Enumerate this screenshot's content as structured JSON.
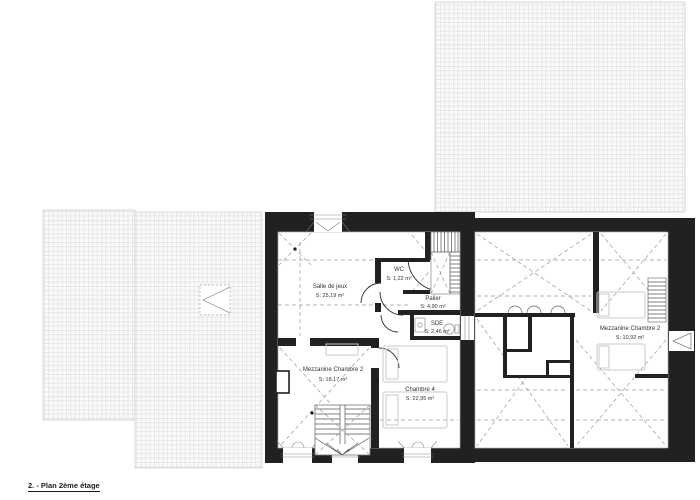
{
  "drawing": {
    "title": "2. - Plan 2ème étage"
  },
  "rooms": {
    "salle_de_jeux": {
      "name": "Salle de jeux",
      "area": "S: 25,19 m²"
    },
    "wc": {
      "name": "WC",
      "area": "S: 1,22 m²"
    },
    "palier": {
      "name": "Palier",
      "area": "S: 4,90 m²"
    },
    "sde": {
      "name": "SDE",
      "area": "S: 2,46 m²"
    },
    "mezzanine_chambre2": {
      "name": "Mezzanine Chambre 2",
      "area": "S: 18,17 m²"
    },
    "chambre4": {
      "name": "Chambre 4",
      "area": "S: 22,95 m²"
    },
    "mezzanine_chambre2_b": {
      "name": "Mezzanine Chambre 2",
      "area": "S: 10,92 m²"
    }
  },
  "colors": {
    "wall": "#212121",
    "hatch_line": "#dedede",
    "dash": "#9a9a9a",
    "furniture": "#c9c9c9",
    "text": "#333333",
    "background": "#ffffff"
  }
}
